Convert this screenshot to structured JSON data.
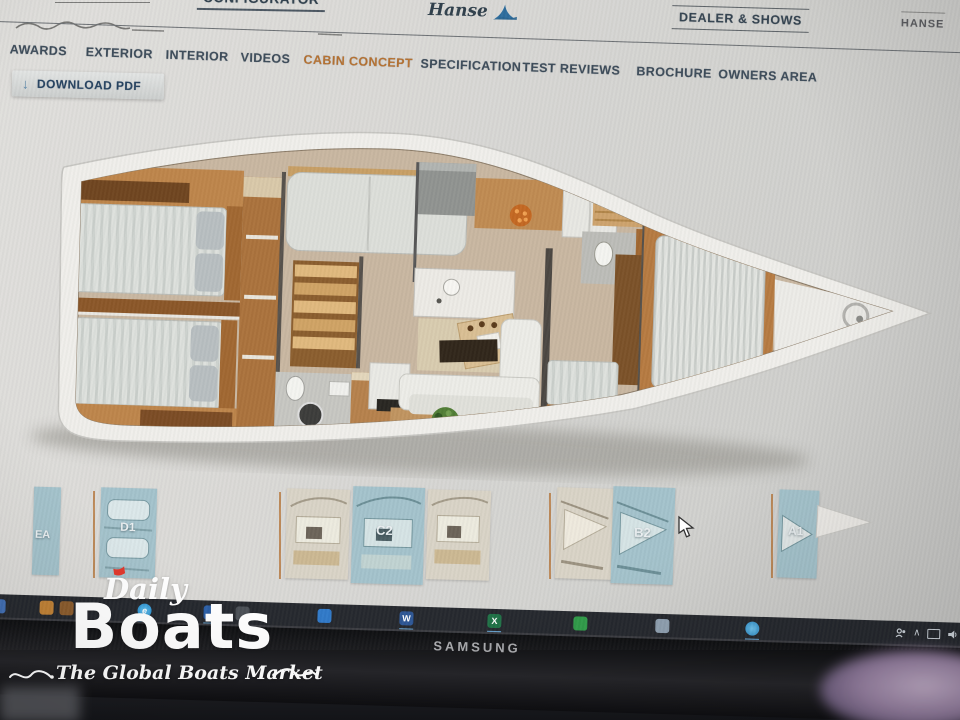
{
  "site_header": {
    "configurator_label": "CONFIGURATOR",
    "brand_name": "Hanse",
    "dealer_shows_label": "DEALER & SHOWS",
    "account_label": "HANSE"
  },
  "model_nav": {
    "active_color": "#b5702f",
    "items": [
      {
        "label": "AWARDS",
        "active": false
      },
      {
        "label": "EXTERIOR",
        "active": false
      },
      {
        "label": "INTERIOR",
        "active": false
      },
      {
        "label": "VIDEOS",
        "active": false
      },
      {
        "label": "CABIN CONCEPT",
        "active": true
      },
      {
        "label": "SPECIFICATION",
        "active": false
      },
      {
        "label": "TEST REVIEWS",
        "active": false
      },
      {
        "label": "BROCHURE",
        "active": false
      },
      {
        "label": "OWNERS AREA",
        "active": false
      }
    ]
  },
  "toolbar": {
    "download_label": "DOWNLOAD PDF",
    "download_icon": "↓"
  },
  "floorplan": {
    "description": "Yacht interior cabin layout, top view, bow pointing right"
  },
  "thumbnail_bar": {
    "selected_color": "#a3c2cb",
    "items": [
      {
        "label": "EA",
        "selected": true
      },
      {
        "label": "D1",
        "selected": true
      },
      {
        "label": "",
        "selected": false
      },
      {
        "label": "C2",
        "selected": true
      },
      {
        "label": "",
        "selected": false
      },
      {
        "label": "",
        "selected": false
      },
      {
        "label": "B2",
        "selected": true
      },
      {
        "label": "A1",
        "selected": true
      }
    ]
  },
  "taskbar": {
    "edge_glyph": "e",
    "word_glyph": "W",
    "excel_glyph": "X",
    "caret_glyph": "∧"
  },
  "monitor": {
    "brand": "SAMSUNG"
  },
  "watermark": {
    "brand_script": "Daily",
    "brand_main": "Boats",
    "tagline": "The Global Boats Market"
  }
}
